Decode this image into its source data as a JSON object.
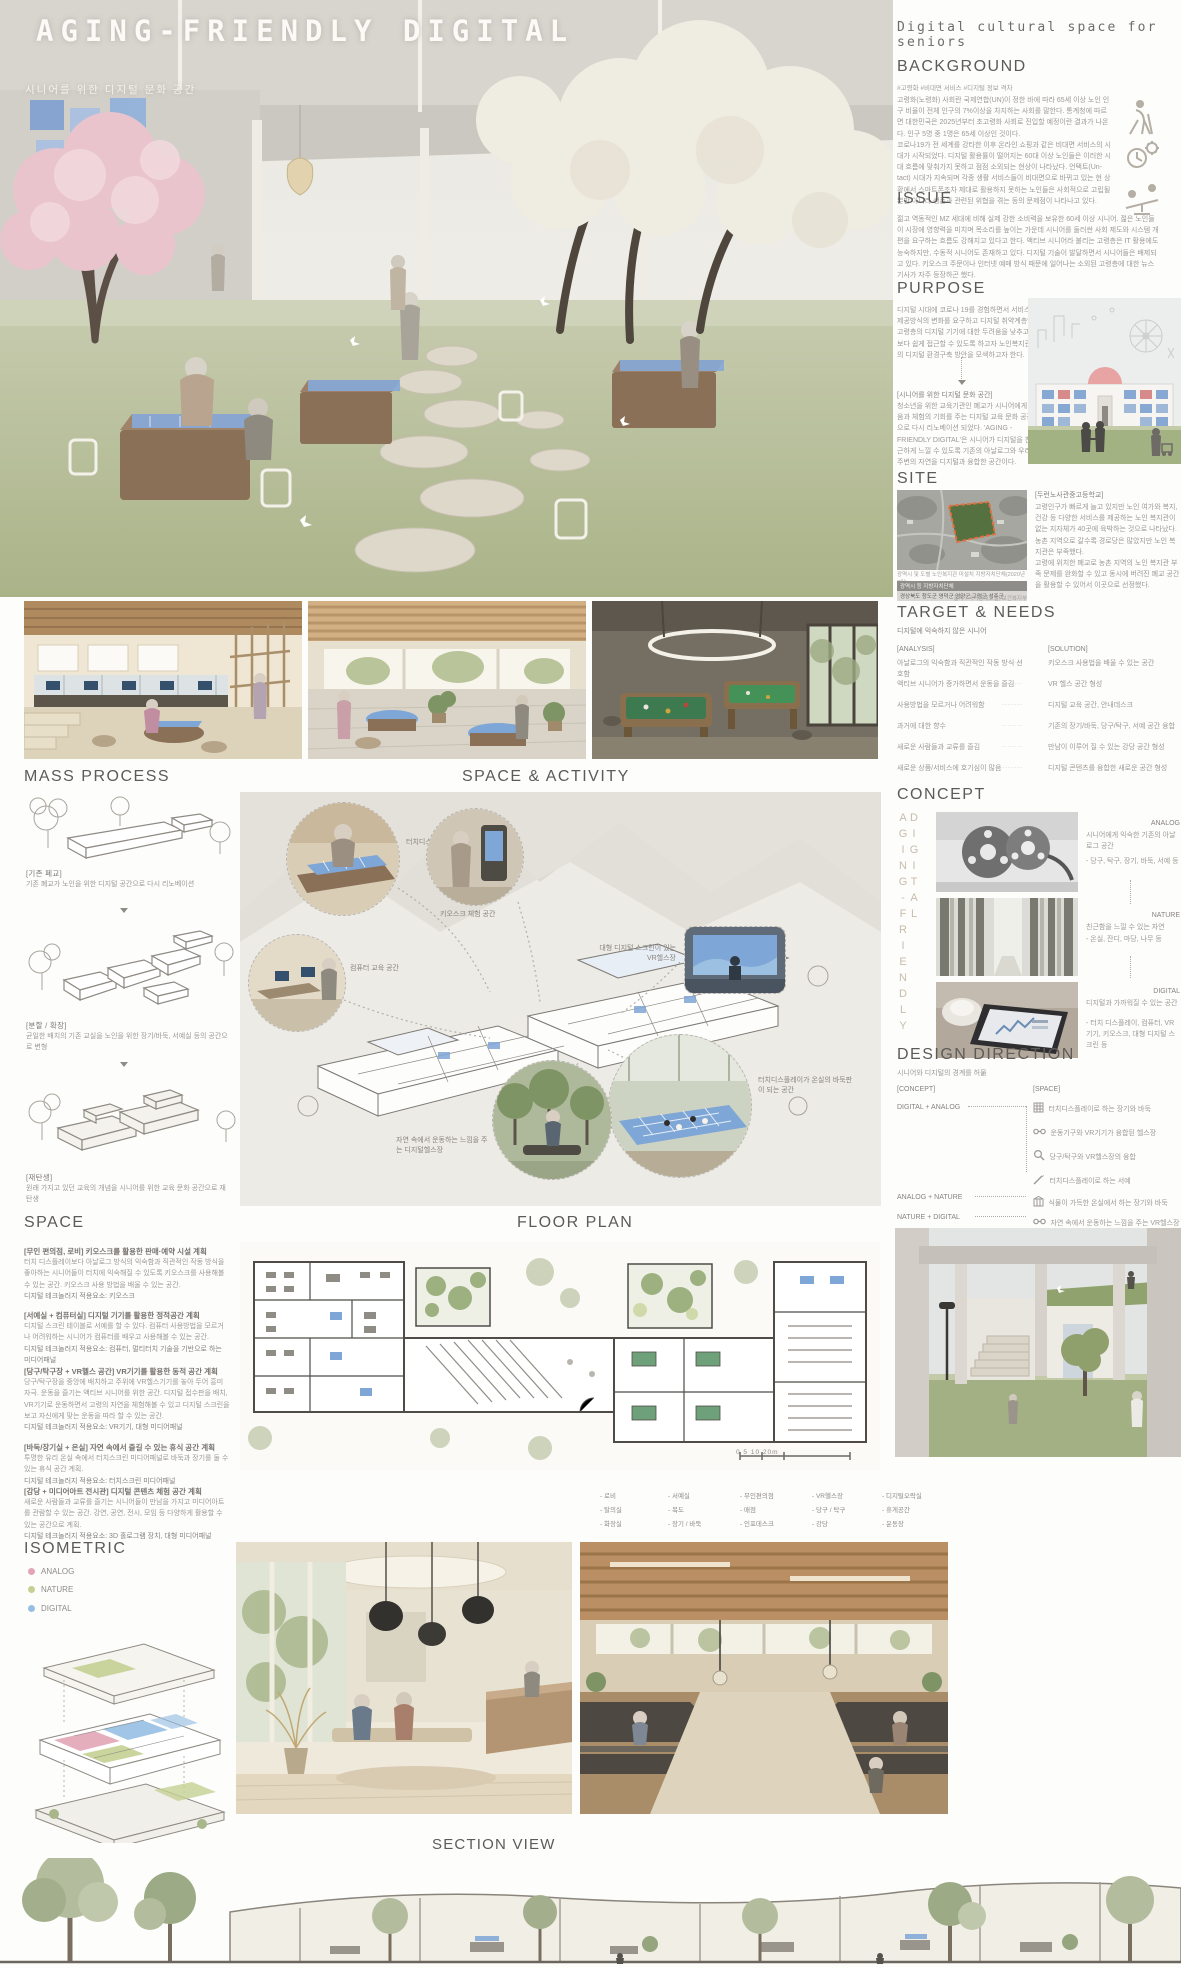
{
  "colors": {
    "analog_pink": "#e2a5b6",
    "nature_green": "#c4cf92",
    "digital_blue": "#97bfe3",
    "screen_blue": "#7ea6d6",
    "site_orange": "#e0703f"
  },
  "header": {
    "title": "AGING-FRIENDLY DIGITAL",
    "subtitle": "시니어를 위한 디지털 문화 공간",
    "right_title": "Digital cultural space for seniors"
  },
  "background": {
    "heading": "BACKGROUND",
    "hashtags": "#고령화 #비대면 서비스 #디지털 정보 격차",
    "body": "고령화(노령화) 사회란 국제연합(UN)이 정한 바에 따라 65세 이상 노인 인구 비율이 전체 인구의 7%이상을 차지하는 사회를 말한다. 통계청에 따르면 대한민국은 2025년부터 초고령화 사회로 진입할 예정이란 결과가 나온다. 인구 5명 중 1명은 65세 이상인 것이다.\n코로나19가 전 세계를 강타한 이후 온라인 쇼핑과 같은 비대면 서비스의 시대가 시작되었다. 디지털 활용률이 떨어지는 60대 이상 노인들은 이러한 시대 흐름에 맞춰가지 못하고 점점 소외되는 현상이 나타났다. 언택트(Un-tact) 시대가 지속되며 각종 생활 서비스들이 비대면으로 바뀌고 있는 현 상황에서 스마트폰조차 제대로 활용하지 못하는 노인들은 사회적으로 고립될 뿐만 아니라 생존과 관련된 위협을 겪는 등의 문제점이 나타나고 있다."
  },
  "issue": {
    "heading": "ISSUE",
    "body": "젊고 역동적인 MZ 세대에 비해 실제 강한 소비력을 보유한 60세 이상 시니어. 젊은 노인들이 시장에 영향력을 미치며 목소리를 높이는 가운데 시니어를 둘러싼 사회 제도와 시스템 개편을 요구하는 흐름도 강해지고 있다고 한다. 액티브 시니어라 불리는 고령층은 IT 활용에도 능숙하지만, 수동적 시니어도 존재하고 있다. 디지털 기술이 발달하면서 시니어들은 배제되고 있다. 키오스크 주문이나 인터넷 예매 방식 때문에 일어나는 소외된 고령층에 대한 뉴스 기사가 자주 등장하곤 했다."
  },
  "purpose": {
    "heading": "PURPOSE",
    "body": "디지털 시대에 코로나 19를 경험하면서 서비스 제공방식의 변화를 요구하고 디지털 취약계층인 고령층의 디지털 기기에 대한 두려움을 낮추고 보다 쉽게 접근할 수 있도록 하고자 노인복지관의 디지털 환경구축 방안을 모색하고자 한다.",
    "callout_title": "[시니어를 위한 디지털 문화 공간]",
    "callout_body": "청소년을 위한 교육기관인 폐교가 시니어에게 배움과 체험의 기회를 주는 디지털 교육 문화 공간으로 다시 리노베이션 되었다. 'AGING - FRIENDLY DIGITAL'은 시니어가 디지털을 친근하게 느낄 수 있도록 기존의 아날로그와 우리 주변의 자연을 디지털과 융합한 공간이다."
  },
  "site": {
    "heading": "SITE",
    "name": "[두런노사관중고등학교]",
    "body": "고령인구가 빠르게 늘고 있지만 노인 여가와 복지, 건강 등 다양한 서비스를 제공하는 노인 복지관이 없는 지자체가 40곳에 육박하는 것으로 나타났다. 농촌 지역으로 갈수록 경로당은 많았지만 노인 복지관은 부족했다.\n고령에 위치한 폐교로 농촌 지역의 노인 복지관 부족 문제를 완화할 수 있고 동시에 버려진 폐교 공간을 활용할 수 있어서 이곳으로 선정했다.",
    "map_caption": "광역시 및 도별 노인복지관 미설치 지방자치단체(2020년 7월)",
    "table_header": "광역시 등        지방자치단체",
    "table_row": "경상북도   청도군  영덕군  영양군  고령군  성주군",
    "source": "출처 : 국가통계포털, 보건복지부"
  },
  "target": {
    "heading": "TARGET & NEEDS",
    "subtitle": "디지털에 익숙하지 않은 시니어",
    "analysis_label": "[ANALYSIS]",
    "solution_label": "[SOLUTION]",
    "dots": "·······",
    "rows": [
      {
        "a": "아날로그의 익숙함과 직관적인 작동 방식 선호함",
        "s": "키오스크 사용법을 배울 수 있는 공간"
      },
      {
        "a": "액티브 시니어가 증가하면서 운동을 즐김",
        "s": "VR 헬스 공간 형성"
      },
      {
        "a": "사용방법을 모르거나 어려워함",
        "s": "디지털 교육 공간, 안내데스크"
      },
      {
        "a": "과거에 대한 향수",
        "s": "기존의 장기/바둑, 당구/탁구, 서예 공간 융합"
      },
      {
        "a": "새로운 사람들과 교류를 즐김",
        "s": "만남이 이루어 질 수 있는 강당 공간 형성"
      },
      {
        "a": "새로운 상품/서비스에 호기심이 많음",
        "s": "디지털 콘텐츠를 융합한 새로운 공간 형성"
      }
    ]
  },
  "concept": {
    "heading": "CONCEPT",
    "vertical_text": "AGING-FRIENDLY DIGITAL",
    "items": [
      {
        "name": "ANALOG",
        "desc": "시니어에게 익숙한 기존의 아날로그 공간",
        "detail": "- 당구, 탁구, 장기, 바둑, 서예 등"
      },
      {
        "name": "NATURE",
        "desc": "친근함을 느낄 수 있는 자연",
        "detail": "- 온실, 잔디, 마당, 나무 등"
      },
      {
        "name": "DIGITAL",
        "desc": "디지털과 가까워질 수 있는 공간",
        "detail": "- 터치 디스플레이, 컴퓨터, VR기기, 키오스크, 대형 디지털 스크린 등"
      }
    ]
  },
  "design_direction": {
    "heading": "DESIGN DIRECTION",
    "subtitle": "시니어와 디지털의 경계를 허묾",
    "concept_label": "[CONCEPT]",
    "space_label": "[SPACE]",
    "groups": [
      {
        "concept": "DIGITAL + ANALOG",
        "items": [
          "터치디스플레이로 하는 장기와 바둑",
          "운동기구와 VR기기가 융합된 헬스장",
          "당구/탁구와 VR헬스장의 융합",
          "터치디스플레이로 하는 서예"
        ]
      },
      {
        "concept": "ANALOG + NATURE",
        "items": [
          "식물이 가득한 온실에서 하는 장기와 바둑"
        ]
      },
      {
        "concept": "NATURE + DIGITAL",
        "items": [
          "자연 속에서 운동하는 느낌을 주는 VR헬스장"
        ]
      }
    ]
  },
  "mass_process": {
    "heading": "MASS PROCESS",
    "steps": [
      {
        "tag": "[기존 폐교]",
        "desc": "기존 폐교가 노인을 위한 디지털 공간으로 다시 리노베이션"
      },
      {
        "tag": "[분할 / 확장]",
        "desc": "균일한 배치의 기존 교실을 노인을 위한 장기/바둑, 서예실 등의 공간으로 변형"
      },
      {
        "tag": "[재탄생]",
        "desc": "원래 가지고 있던 교육의 개념을 시니어를 위한 교육 문화 공간으로 재탄생"
      }
    ]
  },
  "space_activity": {
    "heading": "SPACE & ACTIVITY",
    "labels": [
      "터치디스플레이 서예 공간",
      "키오스크 체험 공간",
      "컴퓨터 교육 공간",
      "대형 디지털 스크린이 있는 VR헬스장",
      "터치디스플레이가 온실의 바둑판이 되는 공간",
      "자연 속에서 운동하는 느낌을 주는 디지털헬스장"
    ]
  },
  "space": {
    "heading": "SPACE",
    "blocks": [
      {
        "title": "[무인 편의점, 로비] 키오스크를 활용한 판매·예약 시설 계획",
        "body": "터치 디스플레이보다 아날로그 방식의 익숙함과 직관적인 작동 방식을 좋아하는 시니어들이 터치에 익숙해질 수 있도록 키오스크를 사용해볼 수 있는 공간. 키오스크 사용 방법을 배울 수 있는 공간.",
        "tech": "디지털 테크놀러지 적용요소: 키오스크"
      },
      {
        "title": "[서예실 + 컴퓨터실] 디지털 기기를 활용한 정적공간 계획",
        "body": "디지털 스크린 테이블로 서예를 할 수 있다. 컴퓨터 사용방법을 모르거나 어려워하는 시니어가 컴퓨터를 배우고 사용해볼 수 있는 공간.",
        "tech": "디지털 테크놀러지 적용요소: 컴퓨터, 멀티터치 기술을 기반으로 하는 미디어패널"
      },
      {
        "title": "[당구/탁구장 + VR헬스 공간] VR기기를 활용한 동적 공간 계획",
        "body": "당구/탁구장을 중앙에 배치하고 주위에 VR헬스기기를 놓아 두어 흥미 자극. 운동을 즐기는 액티브 시니어를 위한 공간. 디지털 접수판을 배치, VR기기로 운동하면서 고령의 자연을 체험해볼 수 있고 디지털 스크린을 보고 자신에게 맞는 운동을 따라 할 수 있는 공간.",
        "tech": "디지털 테크놀러지 적용요소: VR기기, 대형 미디어패널"
      },
      {
        "title": "[바둑/장기실 + 온실] 자연 속에서 즐길 수 있는 휴식 공간 계획",
        "body": "투명한 유리 온실 속에서 터치스크린 미디어패널로 바둑과 장기를 둘 수 있는 휴식 공간 계획.",
        "tech": "디지털 테크놀러지 적용요소: 터치스크린 미디어패널"
      },
      {
        "title": "[강당 + 미디어아트 전시관] 디지털 콘텐츠 체험 공간 계획",
        "body": "새로운 사람들과 교류를 즐기는 시니어들이 만남을 가지고 미디어아트를 관람할 수 있는 공간. 강연, 공연, 전시, 모임 등 다양하게 활용할 수 있는 공간으로 계획.",
        "tech": "디지털 테크놀러지 적용요소: 3D 홀로그램 장치, 대형 미디어패널"
      }
    ]
  },
  "floor_plan": {
    "heading": "FLOOR PLAN",
    "scale": "0    5    10              20m",
    "legend": [
      [
        "- 로비",
        "- 탈의실",
        "- 화장실"
      ],
      [
        "- 서예실",
        "- 복도",
        "- 장기 / 바둑"
      ],
      [
        "- 무인편의점",
        "- 매점",
        "- 인포데스크"
      ],
      [
        "- VR헬스장",
        "- 당구 / 탁구",
        "- 강당"
      ],
      [
        "- 디지털오락실",
        "- 휴게공간",
        "- 운동장"
      ]
    ]
  },
  "isometric": {
    "heading": "ISOMETRIC",
    "legend": [
      {
        "label": "ANALOG"
      },
      {
        "label": "NATURE"
      },
      {
        "label": "DIGITAL"
      }
    ]
  },
  "section": {
    "heading": "SECTION VIEW"
  }
}
